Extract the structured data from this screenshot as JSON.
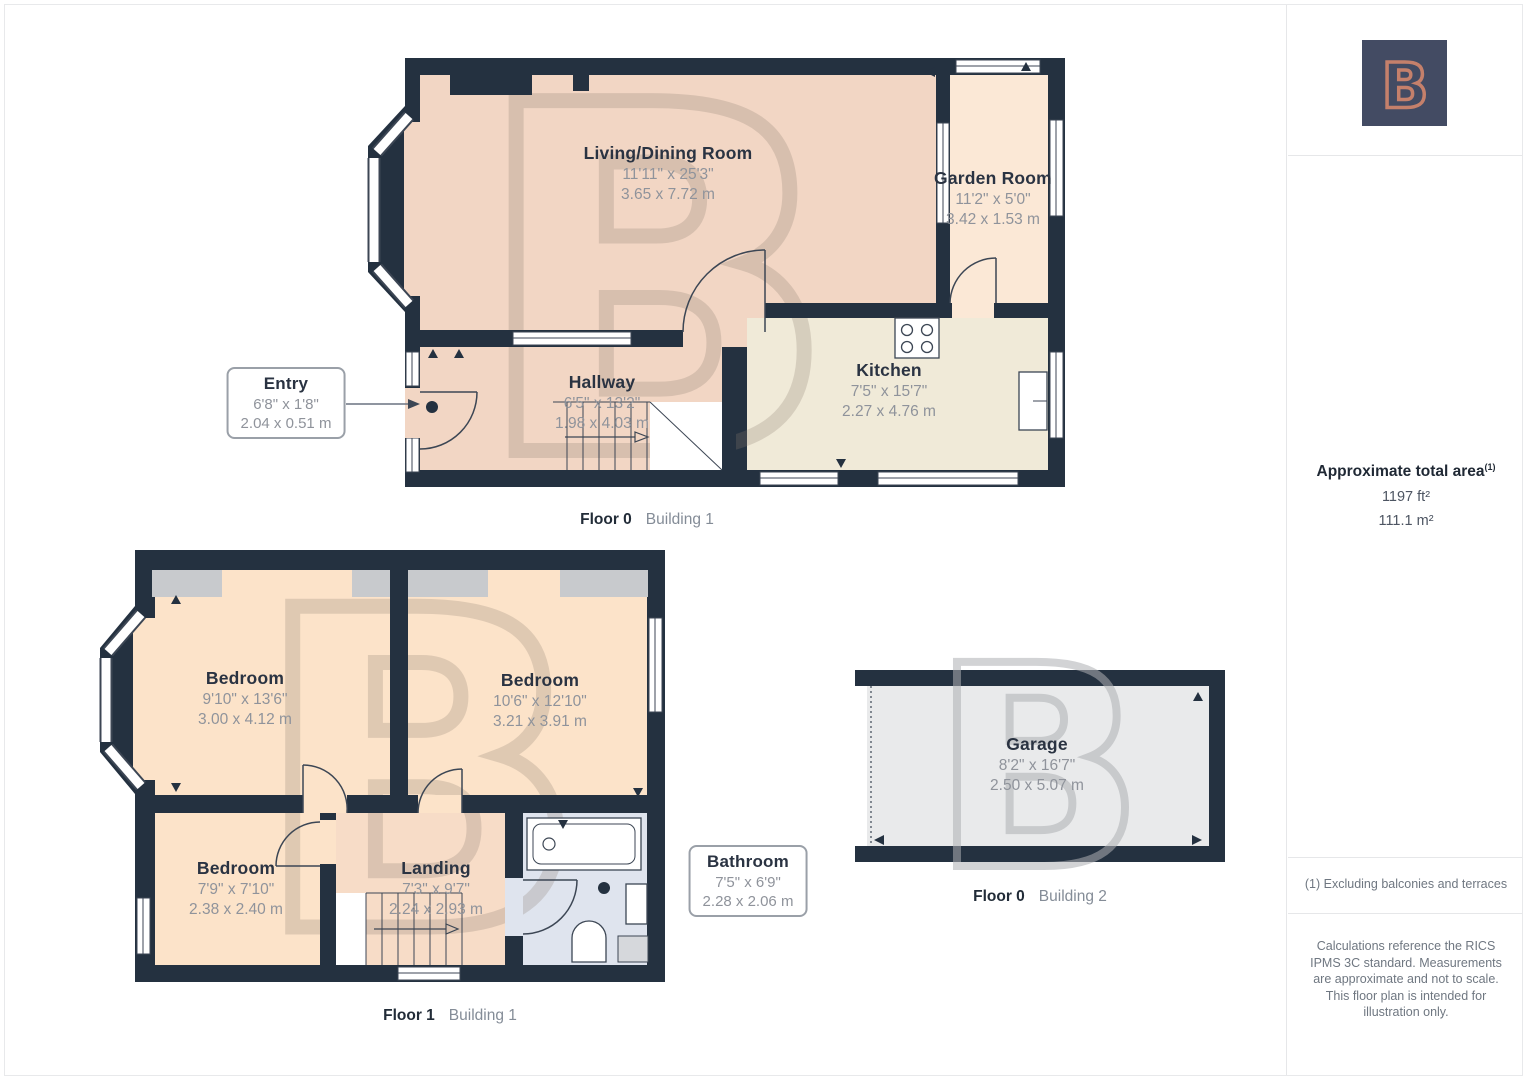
{
  "watermark": {
    "letter": "B"
  },
  "plans": {
    "f0": {
      "caption": {
        "floor": "Floor 0",
        "building": "Building 1"
      },
      "rooms": {
        "living": {
          "name": "Living/Dining Room",
          "imperial": "11'11\" x 25'3\"",
          "metric": "3.65 x 7.72 m"
        },
        "garden": {
          "name": "Garden Room",
          "imperial": "11'2\" x 5'0\"",
          "metric": "3.42 x 1.53 m"
        },
        "kitchen": {
          "name": "Kitchen",
          "imperial": "7'5\" x 15'7\"",
          "metric": "2.27 x 4.76 m"
        },
        "hallway": {
          "name": "Hallway",
          "imperial": "6'5\" x 13'2\"",
          "metric": "1.98 x 4.03 m"
        },
        "entry": {
          "name": "Entry",
          "imperial": "6'8\" x 1'8\"",
          "metric": "2.04 x 0.51 m"
        }
      }
    },
    "f1": {
      "caption": {
        "floor": "Floor 1",
        "building": "Building 1"
      },
      "rooms": {
        "bedroom1": {
          "name": "Bedroom",
          "imperial": "9'10\" x 13'6\"",
          "metric": "3.00 x 4.12 m"
        },
        "bedroom2": {
          "name": "Bedroom",
          "imperial": "10'6\" x 12'10\"",
          "metric": "3.21 x 3.91 m"
        },
        "bedroom3": {
          "name": "Bedroom",
          "imperial": "7'9\" x 7'10\"",
          "metric": "2.38 x 2.40 m"
        },
        "landing": {
          "name": "Landing",
          "imperial": "7'3\" x 9'7\"",
          "metric": "2.24 x 2.93 m"
        },
        "bathroom": {
          "name": "Bathroom",
          "imperial": "7'5\" x 6'9\"",
          "metric": "2.28 x 2.06 m"
        }
      }
    },
    "f0b2": {
      "caption": {
        "floor": "Floor 0",
        "building": "Building 2"
      },
      "rooms": {
        "garage": {
          "name": "Garage",
          "imperial": "8'2\" x 16'7\"",
          "metric": "2.50 x 5.07 m"
        }
      }
    }
  },
  "sidebar": {
    "logo_letter": "B",
    "area_heading": "Approximate total area",
    "area_sup": "(1)",
    "area_ft": "1197 ft²",
    "area_m": "111.1 m²",
    "footnote": "(1) Excluding balconies and terraces",
    "disclaimer": "Calculations reference the RICS IPMS 3C standard. Measurements are approximate and not to scale. This floor plan is intended for illustration only."
  },
  "colors": {
    "wall": "#243140",
    "floor_pink": "#f2d6c4",
    "floor_peach": "#fce3c9",
    "floor_cream": "#fbe8d6",
    "floor_beige": "#f0ead8",
    "floor_bath": "#dfe4ee",
    "floor_garage": "#e9eaeb",
    "logo_bg": "#434b63",
    "logo_accent": "#c5806b"
  }
}
